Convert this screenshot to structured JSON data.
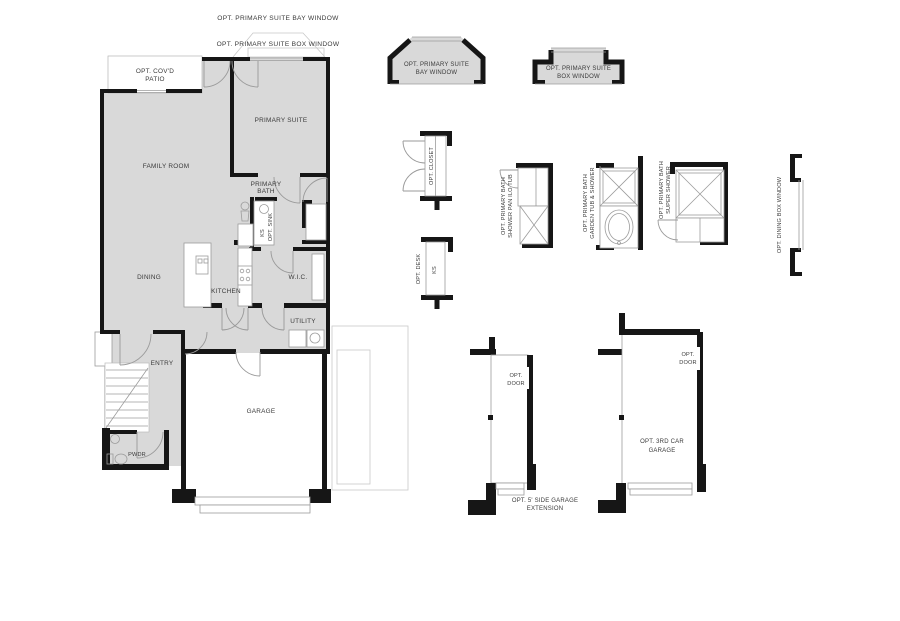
{
  "colors": {
    "wall": "#161616",
    "room_fill": "#d9d9d9",
    "thin_line": "#9c9c9c",
    "light_line": "#c9c9c9",
    "text": "#3a3a3a",
    "background": "#ffffff"
  },
  "top_annotations": {
    "bay_window": "OPT. PRIMARY SUITE BAY WINDOW",
    "box_window": "OPT. PRIMARY SUITE BOX WINDOW"
  },
  "rooms": {
    "patio_line1": "OPT. COV'D",
    "patio_line2": "PATIO",
    "family_room": "FAMILY ROOM",
    "primary_suite": "PRIMARY SUITE",
    "primary_bath_line1": "PRIMARY",
    "primary_bath_line2": "BATH",
    "ks": "KS",
    "opt_sink": "OPT. SINK",
    "wic": "W.I.C.",
    "kitchen": "KITCHEN",
    "dining": "DINING",
    "utility": "UTILITY",
    "entry": "ENTRY",
    "garage": "GARAGE",
    "pwdr": "PWDR"
  },
  "options": {
    "bay_detail_line1": "OPT. PRIMARY SUITE",
    "bay_detail_line2": "BAY WINDOW",
    "box_detail_line1": "OPT. PRIMARY SUITE",
    "box_detail_line2": "BOX WINDOW",
    "closet": "OPT. CLOSET",
    "desk": "OPT. DESK",
    "desk_ks": "KS",
    "shower_pan_line1": "OPT.  PRIMARY BATH",
    "shower_pan_line2": "SHOWER PAN ILO TUB",
    "garden_tub_line1": "OPT.  PRIMARY BATH",
    "garden_tub_line2": "GARDEN TUB & SHOWER",
    "super_shower_line1": "OPT.  PRIMARY BATH",
    "super_shower_line2": "SUPER SHOWER",
    "dining_box_window": "OPT. DINING BOX WINDOW",
    "door_a_line1": "OPT.",
    "door_a_line2": "DOOR",
    "side_ext_line1": "OPT. 5' SIDE GARAGE",
    "side_ext_line2": "EXTENSION",
    "door_b_line1": "OPT.",
    "door_b_line2": "DOOR",
    "third_car_line1": "OPT.  3RD CAR",
    "third_car_line2": "GARAGE"
  }
}
